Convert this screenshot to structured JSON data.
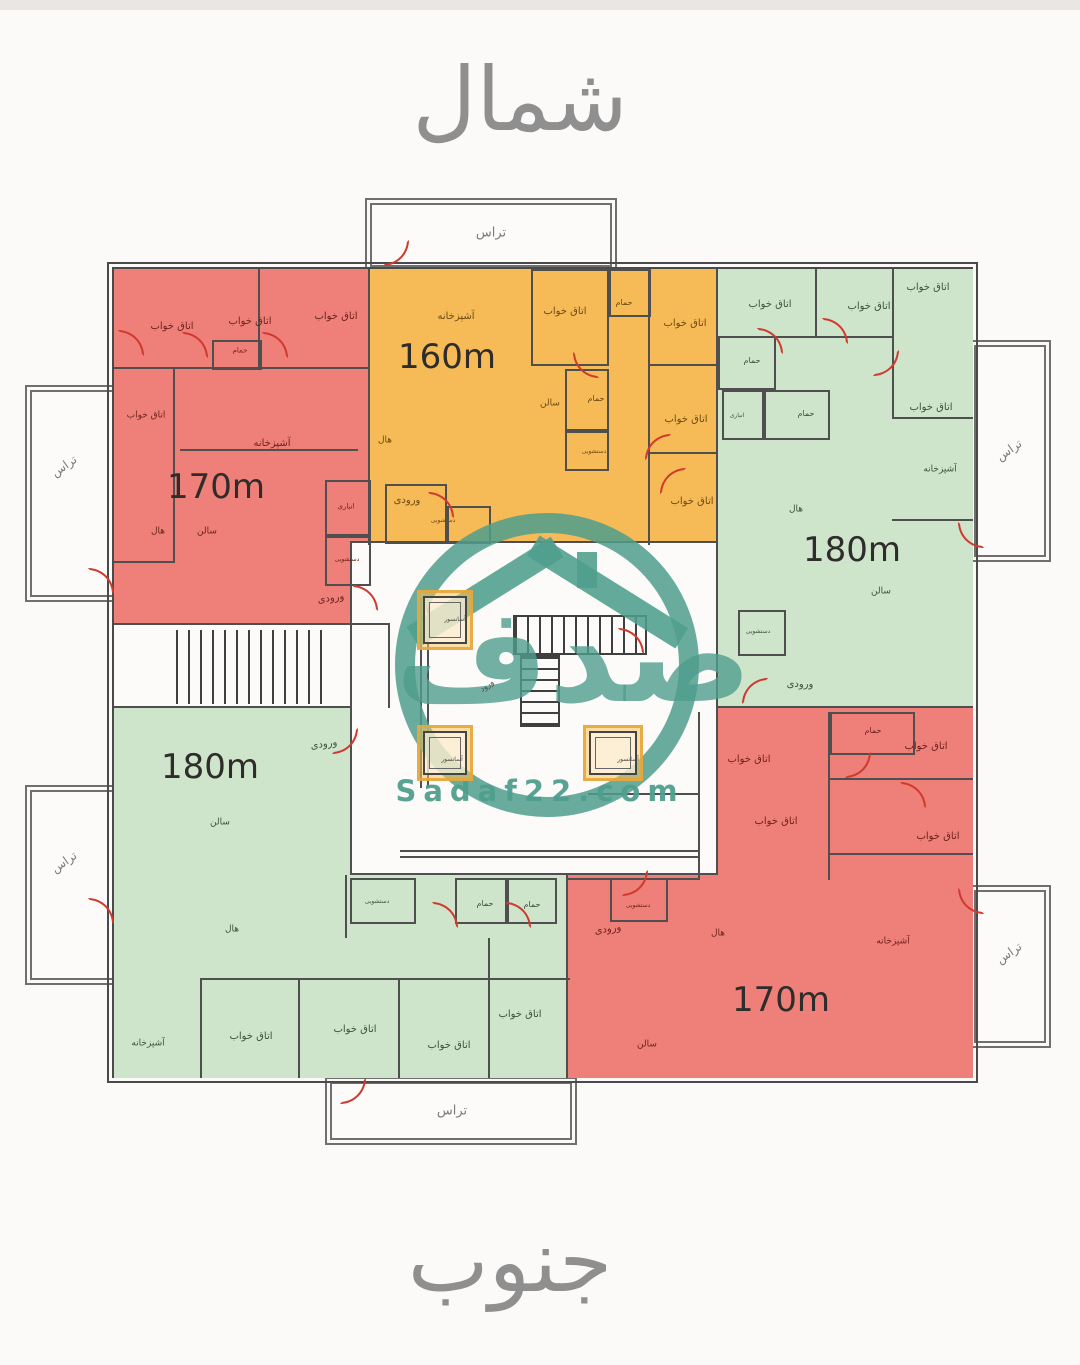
{
  "titles": {
    "north": "شمال",
    "south": "جنوب"
  },
  "watermark": {
    "brand": "صدف",
    "site": "Sadaf22.com",
    "teal": "#4f9e91"
  },
  "colors": {
    "red": "#ef7f79",
    "orange": "#f6bb57",
    "green": "#cfe5cb"
  },
  "apartments": [
    {
      "id": "top-left",
      "color": "red",
      "area_label": "170m"
    },
    {
      "id": "top-middle",
      "color": "orange",
      "area_label": "160m"
    },
    {
      "id": "top-right",
      "color": "green",
      "area_label": "180m"
    },
    {
      "id": "bottom-left",
      "color": "green",
      "area_label": "180m"
    },
    {
      "id": "bottom-right",
      "color": "red",
      "area_label": "170m"
    }
  ],
  "plan": {
    "label_colors": {
      "1": "#6b241b",
      "2": "#6b4a12",
      "3": "#3f4f3e",
      "4": "#7b7b7b",
      "5": "#2e2d2b",
      "6": "#4a4a42"
    },
    "labels": [
      [
        491,
        233,
        13,
        4,
        "تراس"
      ],
      [
        64,
        466,
        12,
        4,
        "تراس",
        -35
      ],
      [
        64,
        862,
        12,
        4,
        "تراس",
        -35
      ],
      [
        1009,
        450,
        12,
        4,
        "تراس",
        -35
      ],
      [
        1009,
        953,
        12,
        4,
        "تراس",
        -35
      ],
      [
        452,
        1111,
        13,
        4,
        "تراس"
      ],
      [
        172,
        327,
        10,
        1,
        "اتاق خواب"
      ],
      [
        250,
        322,
        10,
        1,
        "اتاق خواب"
      ],
      [
        336,
        317,
        10,
        1,
        "اتاق خواب"
      ],
      [
        240,
        351,
        7,
        1,
        "حمام"
      ],
      [
        146,
        416,
        9,
        1,
        "اتاق خواب"
      ],
      [
        272,
        444,
        10,
        1,
        "آشپزخانه"
      ],
      [
        216,
        487,
        34,
        5,
        "170m"
      ],
      [
        158,
        532,
        9,
        1,
        "هال"
      ],
      [
        207,
        532,
        9,
        1,
        "سالن"
      ],
      [
        346,
        507,
        7,
        1,
        "انباری"
      ],
      [
        347,
        560,
        6,
        1,
        "دستشویی"
      ],
      [
        331,
        599,
        10,
        1,
        "ورودی",
        -8
      ],
      [
        456,
        317,
        10,
        2,
        "آشپزخانه"
      ],
      [
        447,
        357,
        34,
        5,
        "160m"
      ],
      [
        565,
        312,
        10,
        2,
        "اتاق خواب"
      ],
      [
        624,
        303,
        8,
        2,
        "حمام"
      ],
      [
        685,
        324,
        10,
        2,
        "اتاق خواب"
      ],
      [
        550,
        404,
        9,
        2,
        "سالن"
      ],
      [
        596,
        399,
        8,
        2,
        "حمام"
      ],
      [
        594,
        452,
        6,
        2,
        "دستشویی"
      ],
      [
        686,
        420,
        10,
        2,
        "اتاق خواب"
      ],
      [
        385,
        441,
        9,
        2,
        "هال"
      ],
      [
        407,
        501,
        10,
        2,
        "ورودی"
      ],
      [
        443,
        521,
        6,
        2,
        "دستشویی"
      ],
      [
        692,
        502,
        10,
        2,
        "اتاق خواب"
      ],
      [
        770,
        305,
        10,
        3,
        "اتاق خواب"
      ],
      [
        869,
        307,
        10,
        3,
        "اتاق خواب"
      ],
      [
        928,
        288,
        10,
        3,
        "اتاق خواب"
      ],
      [
        752,
        361,
        8,
        3,
        "حمام"
      ],
      [
        737,
        416,
        6,
        3,
        "انباری"
      ],
      [
        806,
        414,
        8,
        3,
        "حمام"
      ],
      [
        931,
        408,
        10,
        3,
        "اتاق خواب"
      ],
      [
        940,
        470,
        9,
        3,
        "آشپزخانه"
      ],
      [
        796,
        510,
        9,
        3,
        "هال"
      ],
      [
        852,
        550,
        34,
        5,
        "180m"
      ],
      [
        881,
        592,
        9,
        3,
        "سالن"
      ],
      [
        758,
        632,
        6,
        3,
        "دستشویی"
      ],
      [
        800,
        685,
        10,
        3,
        "ورودی"
      ],
      [
        324,
        745,
        10,
        3,
        "ورودی",
        -8
      ],
      [
        210,
        767,
        34,
        5,
        "180m"
      ],
      [
        220,
        823,
        9,
        3,
        "سالن"
      ],
      [
        232,
        930,
        9,
        3,
        "هال"
      ],
      [
        377,
        902,
        6,
        3,
        "دستشویی"
      ],
      [
        485,
        904,
        8,
        3,
        "حمام"
      ],
      [
        532,
        905,
        8,
        3,
        "حمام"
      ],
      [
        148,
        1044,
        9,
        3,
        "آشپزخانه"
      ],
      [
        251,
        1037,
        10,
        3,
        "اتاق خواب"
      ],
      [
        355,
        1030,
        10,
        3,
        "اتاق خواب"
      ],
      [
        449,
        1046,
        10,
        3,
        "اتاق خواب"
      ],
      [
        520,
        1015,
        10,
        3,
        "اتاق خواب"
      ],
      [
        749,
        760,
        10,
        1,
        "اتاق خواب"
      ],
      [
        873,
        731,
        8,
        1,
        "حمام"
      ],
      [
        926,
        747,
        10,
        1,
        "اتاق خواب"
      ],
      [
        776,
        822,
        10,
        1,
        "اتاق خواب"
      ],
      [
        938,
        837,
        10,
        1,
        "اتاق خواب"
      ],
      [
        638,
        906,
        6,
        1,
        "دستشویی"
      ],
      [
        608,
        930,
        10,
        1,
        "ورودی",
        -8
      ],
      [
        718,
        934,
        9,
        1,
        "هال"
      ],
      [
        893,
        942,
        9,
        1,
        "آشپزخانه"
      ],
      [
        781,
        1000,
        34,
        5,
        "170m"
      ],
      [
        647,
        1045,
        9,
        1,
        "سالن"
      ],
      [
        455,
        620,
        6,
        6,
        "آسانسور"
      ],
      [
        452,
        760,
        6,
        6,
        "آسانسور"
      ],
      [
        628,
        760,
        6,
        6,
        "آسانسور"
      ],
      [
        487,
        686,
        8,
        6,
        "ورود",
        -35
      ]
    ],
    "walls": [
      [
        114,
        623,
        276,
        2
      ],
      [
        114,
        706,
        238,
        2
      ],
      [
        716,
        706,
        257,
        2
      ],
      [
        368,
        269,
        2,
        276
      ],
      [
        716,
        269,
        2,
        441
      ],
      [
        566,
        875,
        2,
        203
      ],
      [
        350,
        541,
        368,
        2
      ],
      [
        350,
        541,
        2,
        334
      ],
      [
        716,
        541,
        2,
        334
      ],
      [
        350,
        873,
        368,
        2
      ],
      [
        388,
        625,
        2,
        83
      ],
      [
        258,
        269,
        2,
        100
      ],
      [
        114,
        367,
        256,
        2
      ],
      [
        173,
        367,
        2,
        196
      ],
      [
        114,
        561,
        61,
        2
      ],
      [
        180,
        449,
        178,
        2
      ],
      [
        648,
        269,
        2,
        276
      ],
      [
        650,
        364,
        68,
        2
      ],
      [
        650,
        452,
        68,
        2
      ],
      [
        718,
        336,
        176,
        2
      ],
      [
        815,
        269,
        2,
        69
      ],
      [
        892,
        269,
        2,
        150
      ],
      [
        892,
        417,
        81,
        2
      ],
      [
        892,
        519,
        81,
        2
      ],
      [
        200,
        978,
        370,
        2
      ],
      [
        298,
        978,
        2,
        100
      ],
      [
        398,
        978,
        2,
        100
      ],
      [
        488,
        938,
        2,
        140
      ],
      [
        200,
        978,
        2,
        100
      ],
      [
        345,
        875,
        2,
        63
      ],
      [
        698,
        712,
        2,
        168
      ],
      [
        828,
        712,
        2,
        168
      ],
      [
        588,
        793,
        110,
        2
      ],
      [
        828,
        778,
        145,
        2
      ],
      [
        828,
        853,
        145,
        2
      ],
      [
        568,
        878,
        130,
        2
      ],
      [
        400,
        850,
        300,
        2
      ],
      [
        400,
        856,
        300,
        2
      ],
      [
        420,
        598,
        2,
        190
      ],
      [
        427,
        598,
        2,
        190
      ]
    ],
    "boxes": [
      [
        212,
        340,
        50,
        30
      ],
      [
        325,
        480,
        46,
        56
      ],
      [
        325,
        536,
        46,
        50
      ],
      [
        531,
        269,
        78,
        97
      ],
      [
        609,
        269,
        42,
        48
      ],
      [
        565,
        369,
        44,
        62
      ],
      [
        565,
        431,
        44,
        40
      ],
      [
        385,
        484,
        62,
        60
      ],
      [
        447,
        506,
        44,
        38
      ],
      [
        718,
        336,
        58,
        54
      ],
      [
        722,
        390,
        42,
        50
      ],
      [
        764,
        390,
        66,
        50
      ],
      [
        738,
        610,
        48,
        46
      ],
      [
        350,
        878,
        66,
        46
      ],
      [
        455,
        878,
        52,
        46
      ],
      [
        507,
        878,
        50,
        46
      ],
      [
        830,
        712,
        85,
        43
      ],
      [
        610,
        878,
        58,
        44
      ]
    ],
    "doors": [
      [
        383,
        240,
        90
      ],
      [
        88,
        568,
        0
      ],
      [
        88,
        898,
        0
      ],
      [
        958,
        522,
        180
      ],
      [
        958,
        888,
        180
      ],
      [
        340,
        1078,
        90
      ],
      [
        182,
        332,
        0
      ],
      [
        262,
        332,
        0
      ],
      [
        118,
        330,
        0
      ],
      [
        352,
        585,
        0
      ],
      [
        573,
        352,
        180
      ],
      [
        645,
        434,
        270
      ],
      [
        428,
        492,
        0
      ],
      [
        660,
        468,
        270
      ],
      [
        757,
        328,
        0
      ],
      [
        822,
        318,
        0
      ],
      [
        873,
        350,
        90
      ],
      [
        742,
        678,
        270
      ],
      [
        332,
        728,
        90
      ],
      [
        432,
        902,
        0
      ],
      [
        505,
        902,
        0
      ],
      [
        622,
        870,
        90
      ],
      [
        900,
        782,
        0
      ],
      [
        845,
        752,
        90
      ],
      [
        618,
        628,
        0
      ]
    ],
    "elevators": [
      [
        423,
        596,
        44,
        48
      ],
      [
        423,
        731,
        44,
        44
      ],
      [
        589,
        731,
        48,
        44
      ]
    ]
  }
}
